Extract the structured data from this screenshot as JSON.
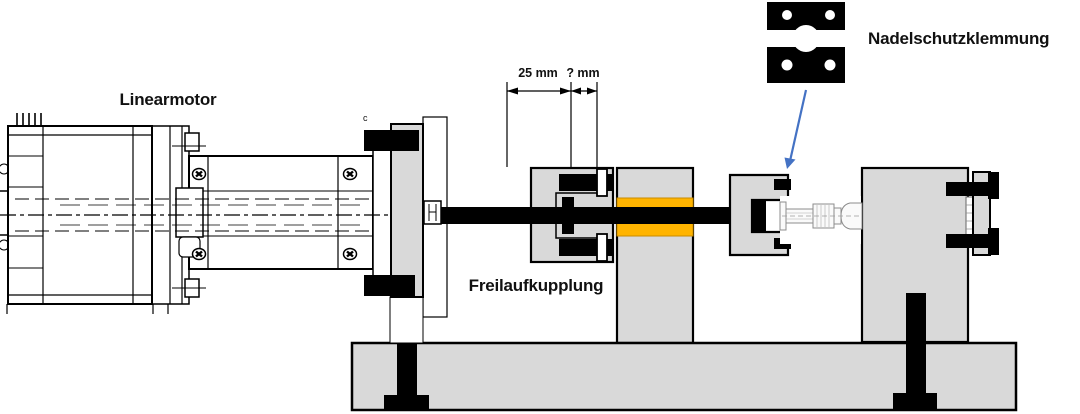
{
  "page": {
    "background": "#FFFFFF"
  },
  "diagram": {
    "labels": {
      "motor": "Linearmotor",
      "clutch": "Freilaufkupplung",
      "needle_clamp": "Nadelschutzklemmung",
      "dim_left": "25 mm",
      "dim_right": "? mm",
      "corner_mark": "c"
    },
    "colors": {
      "gray": "#D9D9D9",
      "orange": "#FFB400",
      "orange_edge": "#C98C00",
      "arrow_blue": "#4472C4",
      "line": "#000000"
    }
  }
}
